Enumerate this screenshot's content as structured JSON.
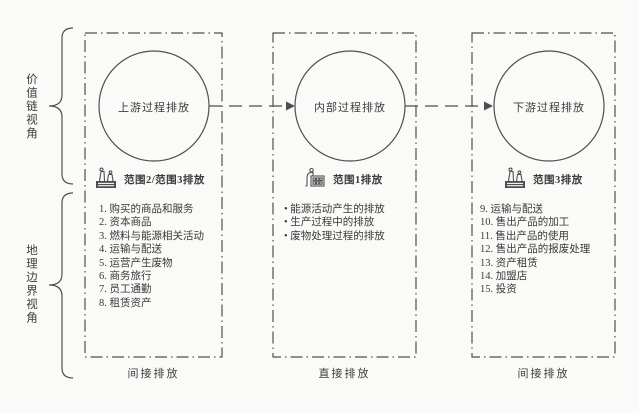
{
  "colors": {
    "line": "#4f4f4f",
    "text": "#3a3a3a",
    "background": "#fafaf8"
  },
  "side_labels": {
    "value_chain": "价值链视角",
    "geo_boundary": "地理边界视角"
  },
  "columns": [
    {
      "circle_label": "上游过程排放",
      "scope_icon": "factory-smoke-icon",
      "scope_label": "范围2/范围3排放",
      "items": [
        "1. 购买的商品和服务",
        "2. 资本商品",
        "3. 燃料与能源相关活动",
        "4. 运输与配送",
        "5. 运营产生废物",
        "6. 商务旅行",
        "7. 员工通勤",
        "8. 租赁资产"
      ],
      "bottom_label": "间接排放"
    },
    {
      "circle_label": "内部过程排放",
      "scope_icon": "factory-chimney-icon",
      "scope_label": "范围1排放",
      "items": [
        "• 能源活动产生的排放",
        "• 生产过程中的排放",
        "• 废物处理过程的排放"
      ],
      "bottom_label": "直接排放"
    },
    {
      "circle_label": "下游过程排放",
      "scope_icon": "factory-smoke-icon",
      "scope_label": "范围3排放",
      "items": [
        "9. 运输与配送",
        "10. 售出产品的加工",
        "11. 售出产品的使用",
        "12. 售出产品的报废处理",
        "13. 资产租赁",
        "14. 加盟店",
        "15. 投资"
      ],
      "bottom_label": "间接排放"
    }
  ]
}
